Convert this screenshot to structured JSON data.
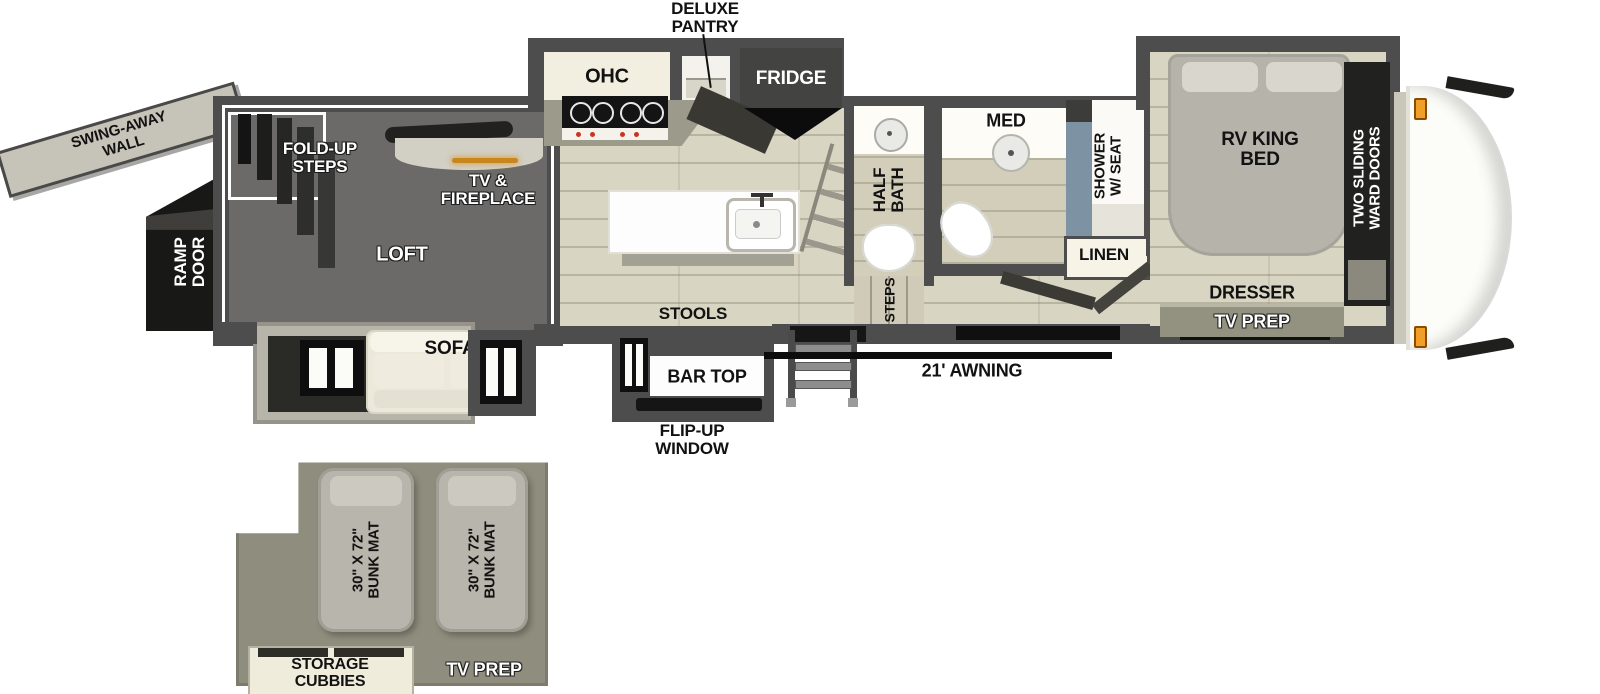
{
  "colors": {
    "wall": "#4d4d4d",
    "floor": "#d9d5c3",
    "loft_interior": "#6b6a68",
    "awning_line": "#0d0d0d",
    "shower_accent": "#7d93a3",
    "fireplace_glow": "#c8861e",
    "marker_light": "#f0a028",
    "bunk_area": "#8f8e7e"
  },
  "rear": {
    "swing_wall_l1": "SWING-AWAY",
    "swing_wall_l2": "WALL",
    "ramp_l1": "RAMP",
    "ramp_l2": "DOOR"
  },
  "garage": {
    "fold_steps_l1": "FOLD-UP",
    "fold_steps_l2": "STEPS",
    "tv_fp_l1": "TV &",
    "tv_fp_l2": "FIREPLACE",
    "loft": "LOFT",
    "sofa": "SOFA"
  },
  "kitchen": {
    "ohc": "OHC",
    "pantry_l1": "DELUXE",
    "pantry_l2": "PANTRY",
    "fridge": "FRIDGE",
    "stools": "STOOLS",
    "bar_top": "BAR TOP",
    "flip_l1": "FLIP-UP",
    "flip_l2": "WINDOW"
  },
  "exterior": {
    "awning": "21' AWNING"
  },
  "bath": {
    "half_l1": "HALF",
    "half_l2": "BATH",
    "steps": "STEPS",
    "med": "MED",
    "shower_l1": "SHOWER",
    "shower_l2": "W/ SEAT",
    "linen": "LINEN"
  },
  "bedroom": {
    "bed_l1": "RV KING",
    "bed_l2": "BED",
    "dresser": "DRESSER",
    "tv_prep": "TV PREP",
    "ward_l1": "TWO SLIDING",
    "ward_l2": "WARD DOORS"
  },
  "loft_plan": {
    "bunks": [
      {
        "line1": "30\" X 72\"",
        "line2": "BUNK MAT"
      },
      {
        "line1": "30\" X 72\"",
        "line2": "BUNK MAT"
      }
    ],
    "storage_l1": "STORAGE",
    "storage_l2": "CUBBIES",
    "tv_prep": "TV PREP"
  }
}
